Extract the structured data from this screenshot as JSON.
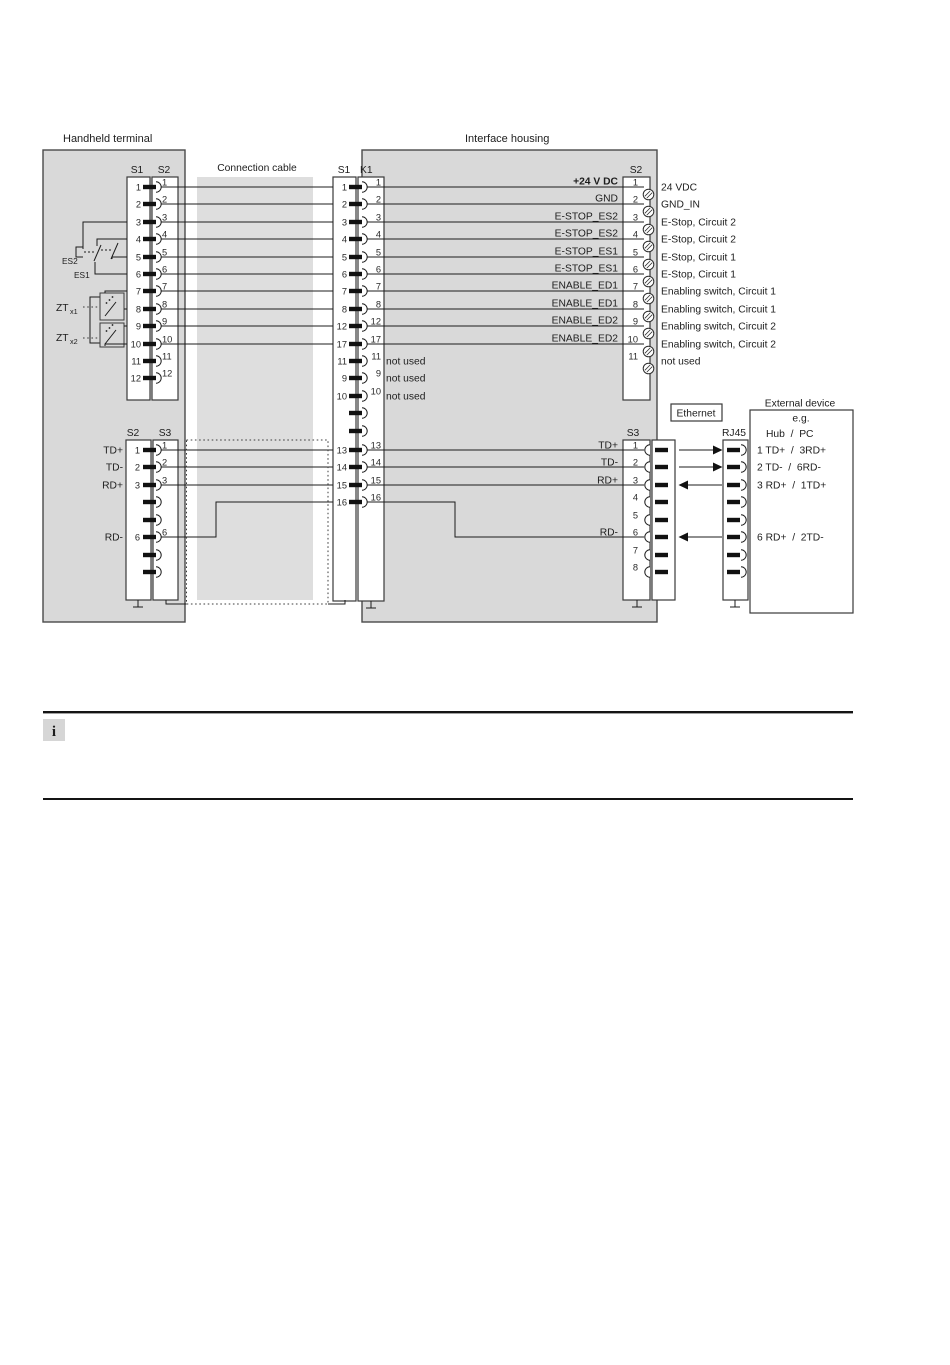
{
  "titles": {
    "handheld": "Handheld terminal",
    "interface": "Interface housing",
    "cable": "Connection cable"
  },
  "headers": {
    "hh_s1": "S1",
    "hh_s2": "S2",
    "mid_s1": "S1",
    "mid_k1": "K1",
    "if_s2": "S2",
    "eth_s2": "S2",
    "eth_s3": "S3",
    "if_s3": "S3",
    "rj45": "RJ45"
  },
  "switches": {
    "es2": "ES2",
    "es1": "ES1",
    "zt": "ZT",
    "zt1": "x1",
    "zt2": "x2"
  },
  "hh_pins": [
    "1",
    "2",
    "3",
    "4",
    "5",
    "6",
    "7",
    "8",
    "9",
    "10",
    "11",
    "12"
  ],
  "mid_rows": [
    {
      "a": "1",
      "b": "1"
    },
    {
      "a": "2",
      "b": "2"
    },
    {
      "a": "3",
      "b": "3"
    },
    {
      "a": "4",
      "b": "4"
    },
    {
      "a": "5",
      "b": "5"
    },
    {
      "a": "6",
      "b": "6"
    },
    {
      "a": "7",
      "b": "7"
    },
    {
      "a": "8",
      "b": "8"
    },
    {
      "a": "12",
      "b": "12"
    },
    {
      "a": "17",
      "b": "17"
    },
    {
      "a": "11",
      "b": "11",
      "note": "not used"
    },
    {
      "a": "9",
      "b": "9",
      "note": "not used"
    },
    {
      "a": "10",
      "b": "10",
      "note": "not used"
    }
  ],
  "mid_eth_rows": [
    {
      "a": "13",
      "b": "13"
    },
    {
      "a": "14",
      "b": "14"
    },
    {
      "a": "15",
      "b": "15"
    },
    {
      "a": "16",
      "b": "16"
    }
  ],
  "if_rows": [
    {
      "pin": "1",
      "signal": "+24 V DC",
      "ext": "24 VDC"
    },
    {
      "pin": "2",
      "signal": "GND",
      "ext": "GND_IN"
    },
    {
      "pin": "3",
      "signal": "E-STOP_ES2",
      "ext": "E-Stop, Circuit 2"
    },
    {
      "pin": "4",
      "signal": "E-STOP_ES2",
      "ext": "E-Stop, Circuit 2"
    },
    {
      "pin": "5",
      "signal": "E-STOP_ES1",
      "ext": "E-Stop, Circuit 1"
    },
    {
      "pin": "6",
      "signal": "E-STOP_ES1",
      "ext": "E-Stop, Circuit 1"
    },
    {
      "pin": "7",
      "signal": "ENABLE_ED1",
      "ext": "Enabling switch, Circuit 1"
    },
    {
      "pin": "8",
      "signal": "ENABLE_ED1",
      "ext": "Enabling switch, Circuit 1"
    },
    {
      "pin": "9",
      "signal": "ENABLE_ED2",
      "ext": "Enabling switch, Circuit 2"
    },
    {
      "pin": "10",
      "signal": "ENABLE_ED2",
      "ext": "Enabling switch, Circuit 2"
    },
    {
      "pin": "11",
      "signal": "",
      "ext": "not used"
    }
  ],
  "eth_hh": {
    "rows": [
      {
        "pin": "1",
        "label": "TD+"
      },
      {
        "pin": "2",
        "label": "TD-"
      },
      {
        "pin": "3",
        "label": "RD+"
      },
      {
        "pin": "6",
        "label": "RD-"
      }
    ]
  },
  "eth_if": {
    "pins": [
      "1",
      "2",
      "3",
      "4",
      "5",
      "6",
      "7",
      "8"
    ],
    "labels": [
      {
        "label": "TD+"
      },
      {
        "label": "TD-"
      },
      {
        "label": "RD+"
      },
      {
        "label": "RD-"
      }
    ]
  },
  "ethernet": {
    "label": "Ethernet"
  },
  "external": {
    "title": "External device",
    "eg": "e.g.",
    "header": "Hub  /  PC",
    "rows": [
      "1 TD+  /  3RD+",
      "2 TD-  /  6RD-",
      "3 RD+  /  1TD+",
      "6 RD+  /  2TD-"
    ]
  },
  "info": {
    "icon": "i"
  },
  "colors": {
    "panel_gray": "#d9d9d9",
    "cable_gray": "#dedede",
    "line": "#1c1c1c"
  }
}
